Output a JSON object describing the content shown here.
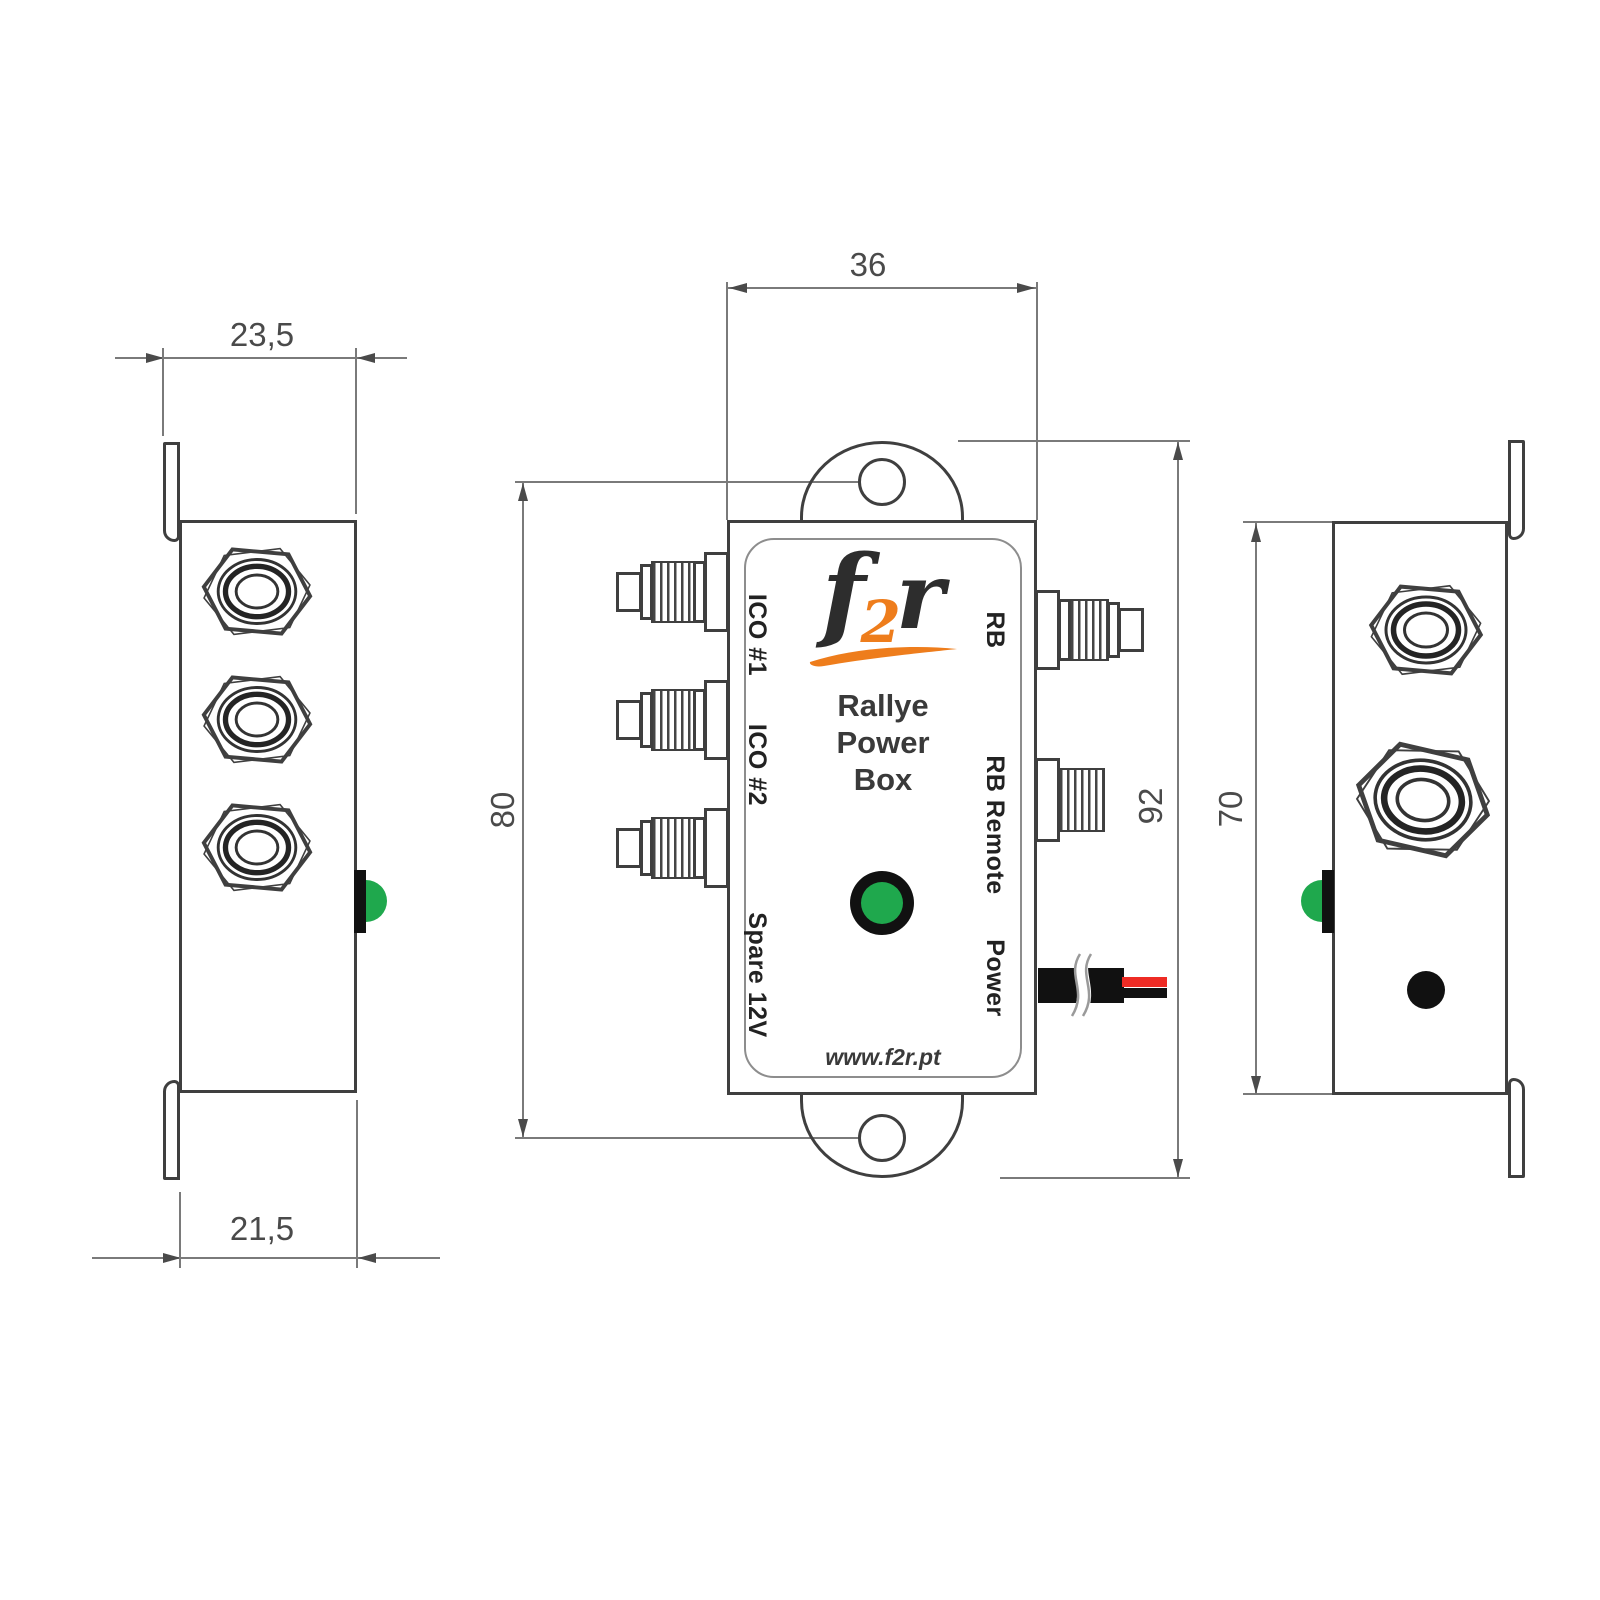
{
  "device": {
    "brand_f": "f",
    "brand_2": "2",
    "brand_r": "r",
    "name_line1": "Rallye",
    "name_line2": "Power",
    "name_line3": "Box",
    "website": "www.f2r.pt"
  },
  "ports": {
    "left": [
      {
        "label": "ICO #1"
      },
      {
        "label": "ICO #2"
      },
      {
        "label": "Spare 12V"
      }
    ],
    "right": [
      {
        "label": "RB"
      },
      {
        "label": "RB Remote"
      },
      {
        "label": "Power"
      }
    ]
  },
  "dimensions_mm": {
    "side_depth_with_flange": "23,5",
    "side_depth_body": "21,5",
    "front_width": "36",
    "mounting_hole_span": "80",
    "total_height_with_tabs": "92",
    "body_height": "70"
  },
  "colors": {
    "led_green": "#1fa84d",
    "logo_orange": "#ee7d1c",
    "wire_red": "#ee2b24",
    "outline": "#3f3f3f"
  }
}
